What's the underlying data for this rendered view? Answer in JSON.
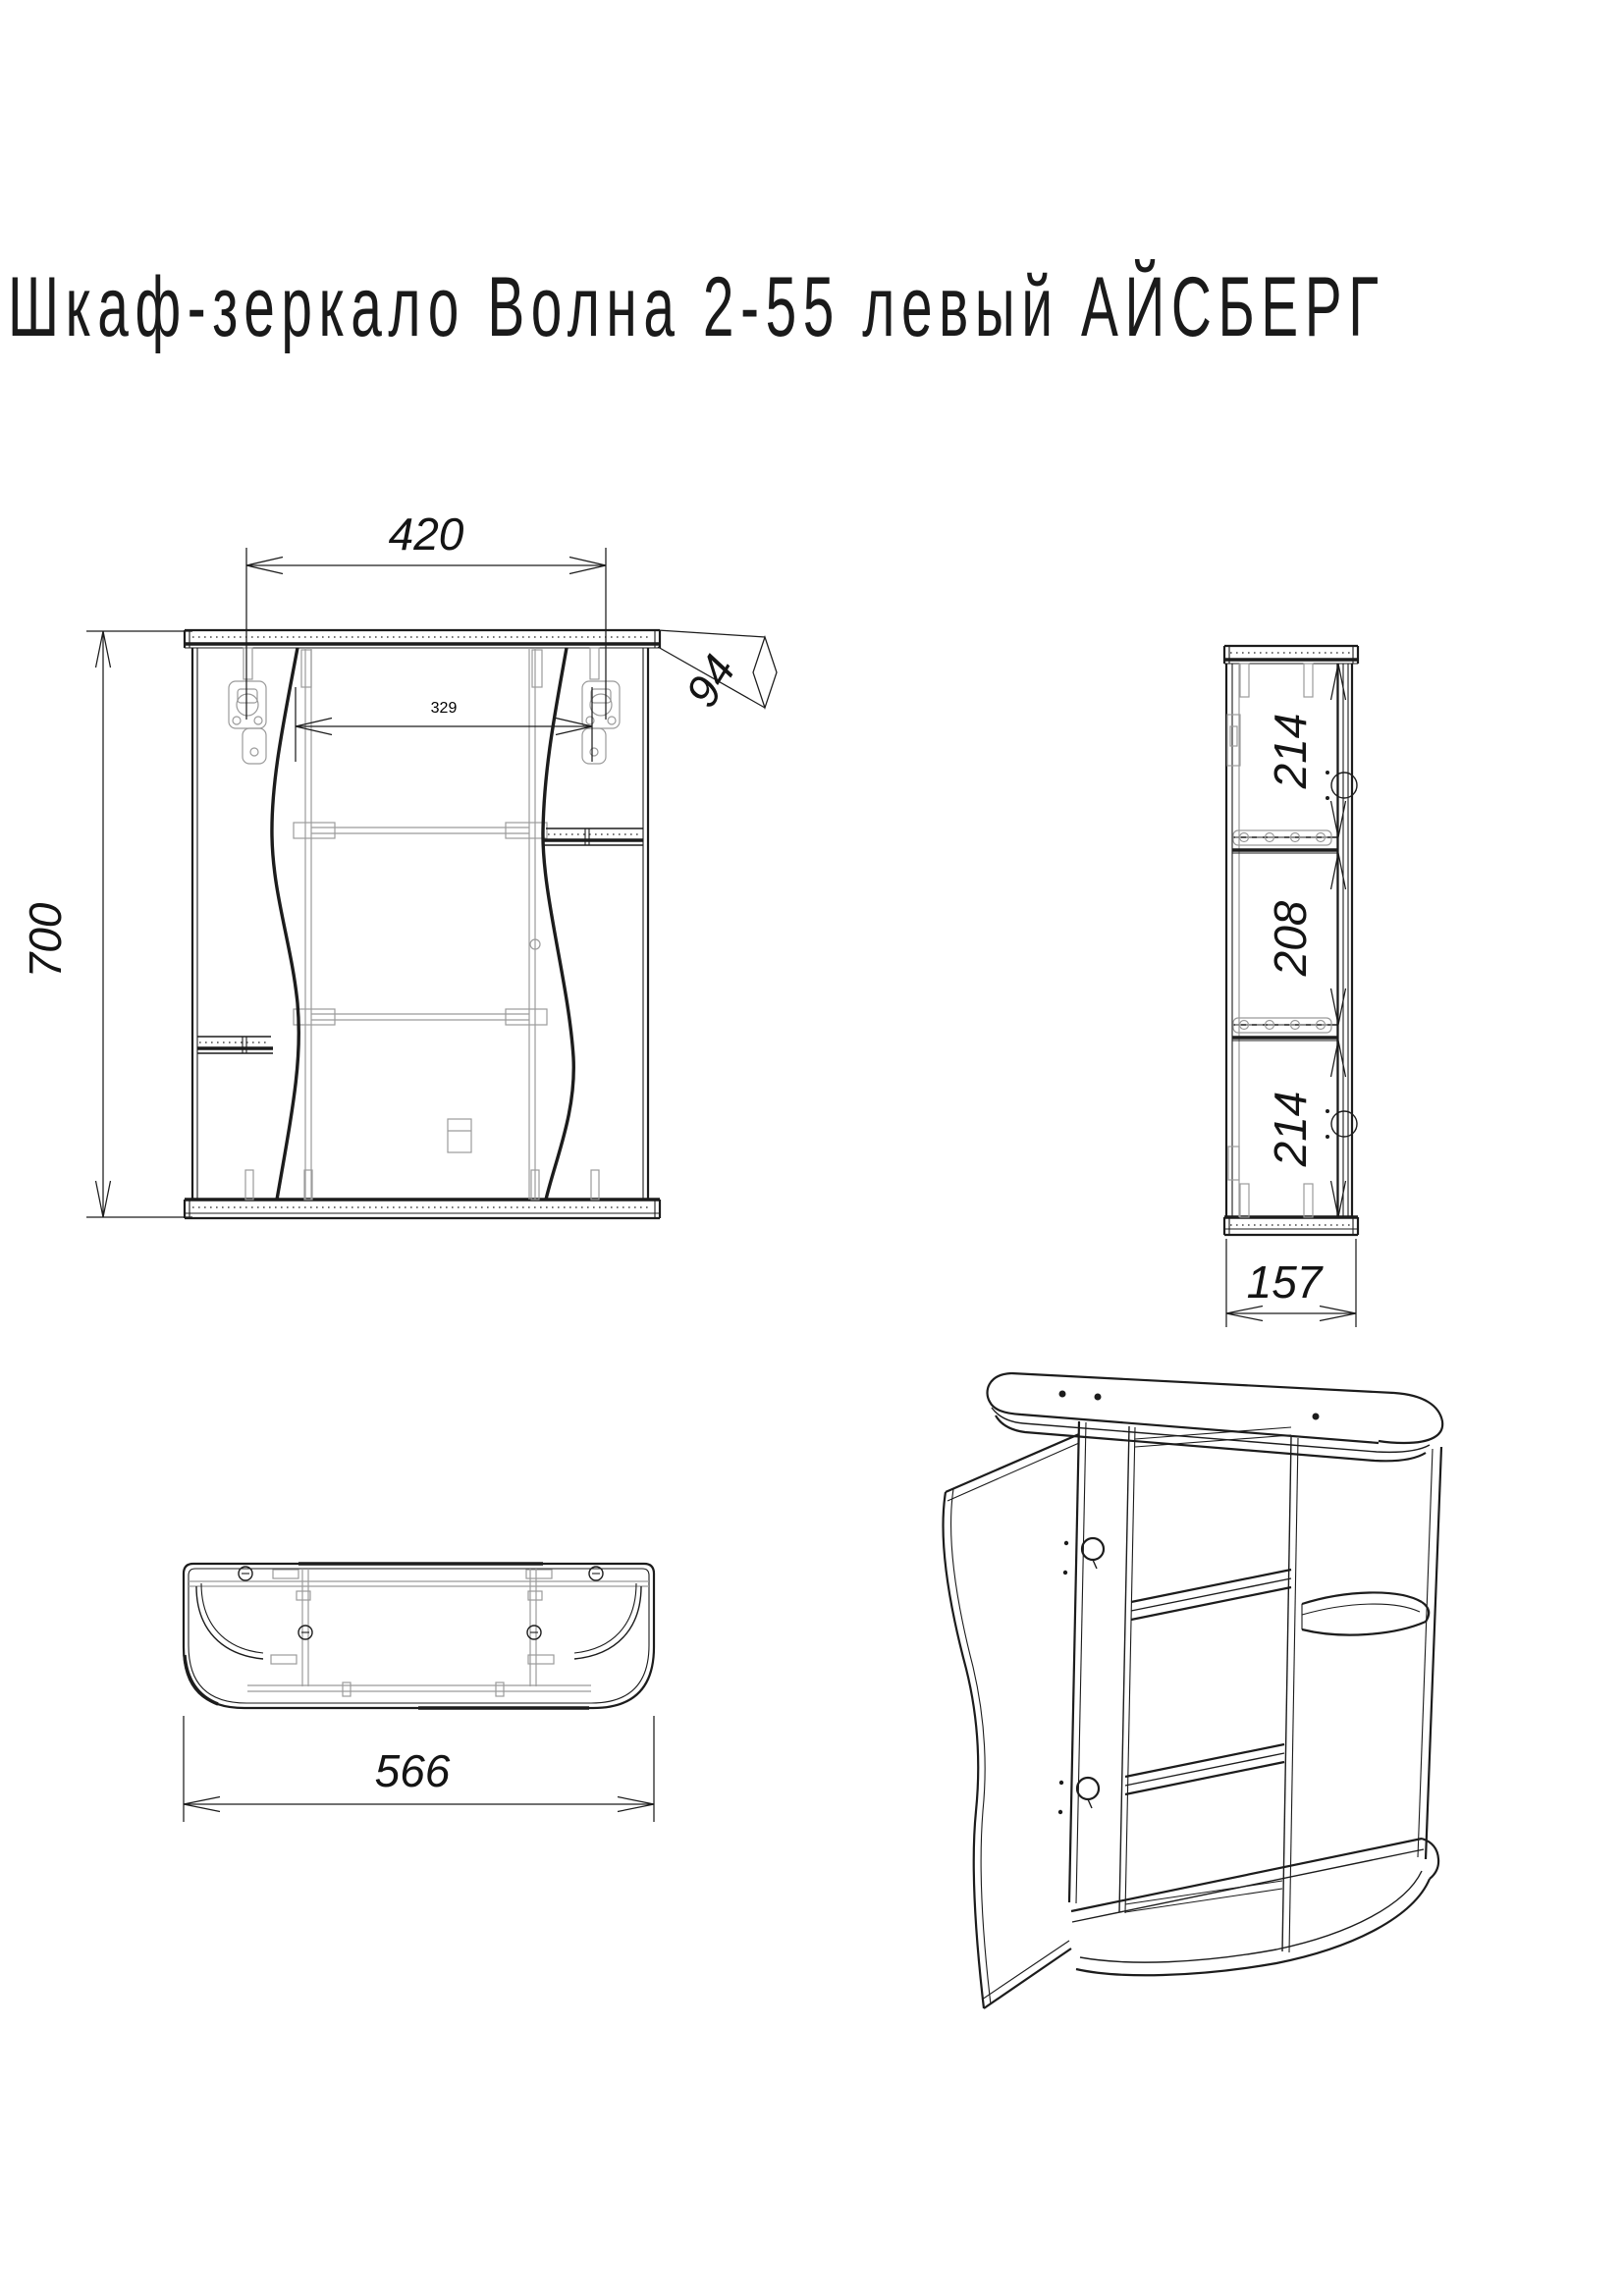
{
  "title": "Шкаф-зеркало Волна 2-55 левый АЙСБЕРГ",
  "dimensions": {
    "front": {
      "overall_width_mm": "420",
      "mirror_width_mm": "329",
      "height_mm": "700",
      "top_panel_depth_mm": "94"
    },
    "side": {
      "top_section_mm": "214",
      "middle_section_mm": "208",
      "bottom_section_mm": "214",
      "depth_mm": "157"
    },
    "bottom": {
      "overall_width_mm": "566"
    }
  },
  "colors": {
    "line": "#1c1c1c",
    "hidden_line": "#9b9b9b",
    "background": "#ffffff"
  }
}
